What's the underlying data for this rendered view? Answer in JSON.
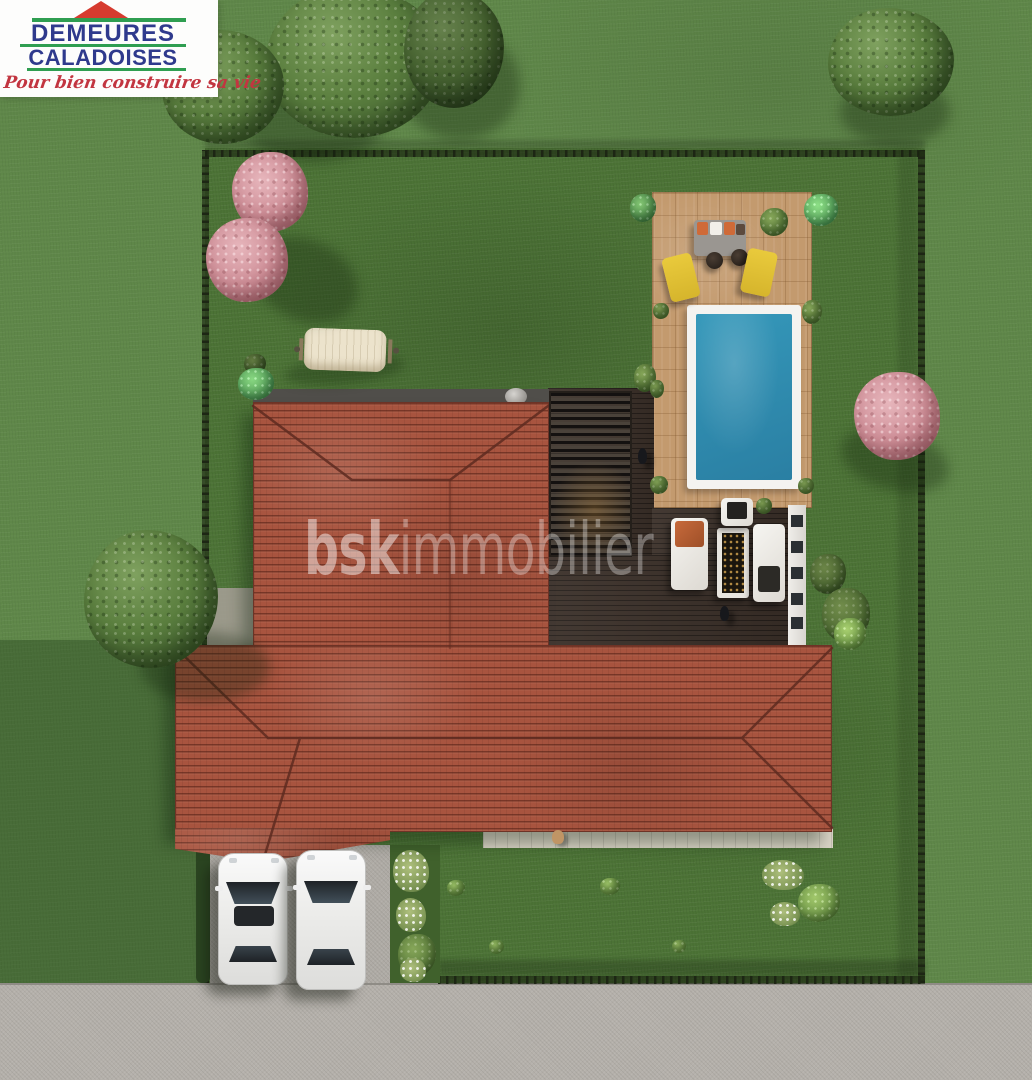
{
  "logo": {
    "line1": "DEMEURES",
    "line2": "CALADOISES",
    "tagline": "Pour bien construire sa vie"
  },
  "watermark": {
    "brand_prefix": "bsk",
    "brand_suffix": "immobilier",
    "icon": "house-in-circle-icon"
  },
  "scene": {
    "description": "Aerial 3D render of a detached house plot",
    "objects": [
      "L-shaped house with terracotta hip roof",
      "rectangular swimming pool with white coping",
      "tan paved pool terrace with gray sofa, two yellow sun loungers and fire poufs",
      "dark wood deck with louvered pergola, white loungers, fire table and sofa",
      "cream hammock on lawn",
      "two white cars parked on gravel driveway",
      "gravel road along bottom edge",
      "dark garden fence enclosing the plot",
      "green trees, pink blossom trees, shrubs and flower beds",
      "two people on the deck and a dog on the rear walkway"
    ],
    "cars_count": 2,
    "people_count": 2
  },
  "colors": {
    "lawn_inner": "#4c7336",
    "lawn_outer": "#5f8749",
    "roof_tile": "#a8543f",
    "roof_ridge": "#5e2b20",
    "pool_water": "#2e8fb2",
    "pool_coping": "#f4f3f0",
    "terrace_paving": "#c39a6e",
    "deck_wood": "#3a2f28",
    "road_gravel": "#b4b0aa",
    "fence": "#1d2614",
    "logo_blue": "#2f3a8d",
    "logo_green": "#2f9e51",
    "logo_red": "#d63b2f",
    "tagline_red": "#c23540",
    "car_body": "#f0f0ee",
    "lounger_yellow": "#e4c237",
    "cushion_orange": "#cf6a38"
  }
}
